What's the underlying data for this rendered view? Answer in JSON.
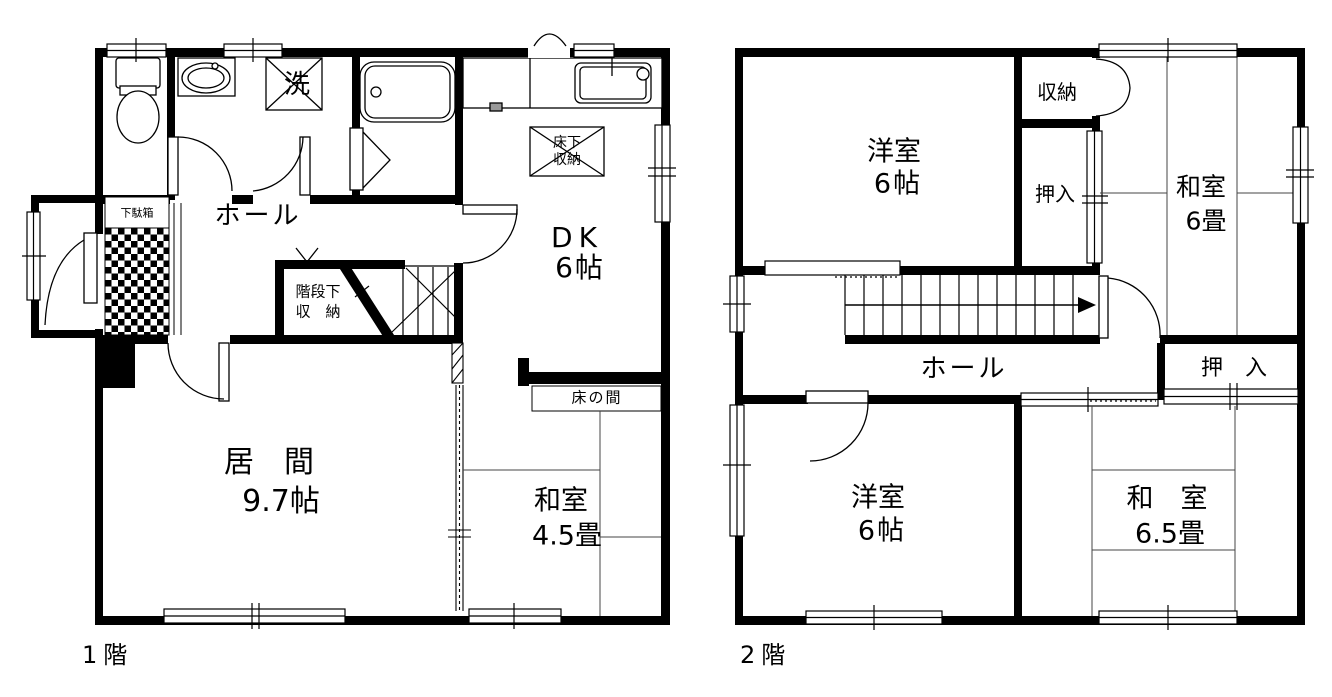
{
  "canvas": {
    "width": 1332,
    "height": 697,
    "background": "#ffffff",
    "line_color": "#000000"
  },
  "floor1": {
    "caption": "1階",
    "labels": {
      "laundry": "洗",
      "underfloor_storage_line1": "床下",
      "underfloor_storage_line2": "収納",
      "hall": "ホール",
      "dk_line1": "DK",
      "dk_line2": "6帖",
      "under_stair_storage_line1": "階段下",
      "under_stair_storage_line2": "収　納",
      "living_line1": "居　間",
      "living_line2": "9.7帖",
      "tokonoma": "床の間",
      "washitsu_line1": "和室",
      "washitsu_line2": "4.5畳",
      "shoe_cabinet": "下駄箱"
    }
  },
  "floor2": {
    "caption": "2階",
    "labels": {
      "yoshitsu_top_line1": "洋室",
      "yoshitsu_top_line2": "6帖",
      "closet_small": "収納",
      "oshiire_upper": "押入",
      "washitsu6_line1": "和室",
      "washitsu6_line2": "6畳",
      "hall": "ホール",
      "oshiire_lower": "押　入",
      "yoshitsu_bottom_line1": "洋室",
      "yoshitsu_bottom_line2": "6帖",
      "washitsu65_line1": "和　室",
      "washitsu65_line2": "6.5畳"
    }
  }
}
